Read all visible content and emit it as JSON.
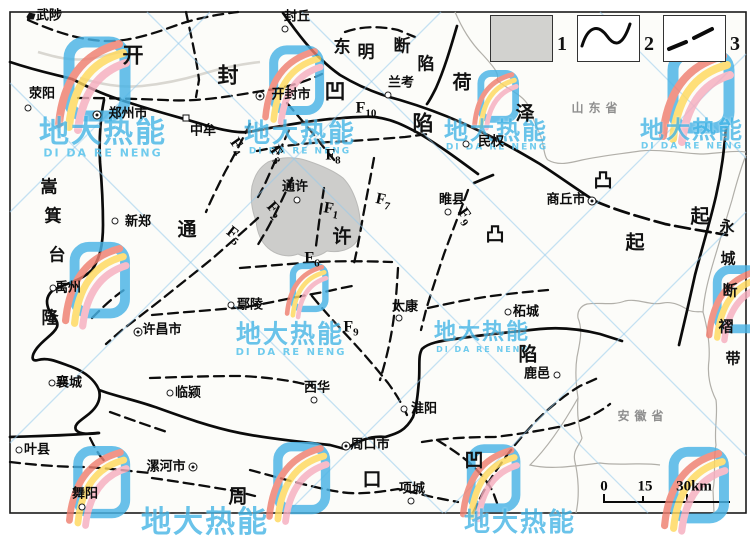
{
  "map_meta": {
    "description": "Regional geological structure sketch map (Henan area) with faults F1-F10",
    "colors": {
      "fault": "#0d0d0d",
      "province_boundary": "#b0aeaa",
      "uplift_shading": "#cbcbc9",
      "watermark_blue": "#45b5e6",
      "paper": "#ffffff"
    }
  },
  "legend": {
    "items": [
      {
        "num": "1",
        "meaning": "shaded-area"
      },
      {
        "num": "2",
        "meaning": "solid-curved-line"
      },
      {
        "num": "3",
        "meaning": "dashed-line"
      }
    ]
  },
  "scale_bar": {
    "labels": [
      "0",
      "15",
      "30km"
    ]
  },
  "provinces": [
    {
      "name": "山东省",
      "x": 597,
      "y": 108
    },
    {
      "name": "安徽省",
      "x": 643,
      "y": 416
    }
  ],
  "region_names": [
    "开封凹陷",
    "东明断陷",
    "荷泽凸起",
    "通许凸起",
    "嵩箕台隆",
    "永城断褶带",
    "周口凹陷"
  ],
  "region_chars": [
    {
      "region": "开封凹陷",
      "c": "开",
      "x": 133,
      "y": 55,
      "size": 21
    },
    {
      "region": "开封凹陷",
      "c": "封",
      "x": 228,
      "y": 75,
      "size": 21
    },
    {
      "region": "开封凹陷",
      "c": "凹",
      "x": 335,
      "y": 91,
      "size": 21
    },
    {
      "region": "开封凹陷",
      "c": "陷",
      "x": 423,
      "y": 123,
      "size": 21
    },
    {
      "region": "东明断陷",
      "c": "东",
      "x": 342,
      "y": 48,
      "size": 17
    },
    {
      "region": "东明断陷",
      "c": "明",
      "x": 366,
      "y": 53,
      "size": 17
    },
    {
      "region": "东明断陷",
      "c": "断",
      "x": 402,
      "y": 47,
      "size": 17
    },
    {
      "region": "东明断陷",
      "c": "陷",
      "x": 426,
      "y": 65,
      "size": 17
    },
    {
      "region": "荷泽凸起",
      "c": "荷",
      "x": 462,
      "y": 83,
      "size": 19
    },
    {
      "region": "荷泽凸起",
      "c": "泽",
      "x": 525,
      "y": 114,
      "size": 19
    },
    {
      "region": "荷泽凸起",
      "c": "凸",
      "x": 603,
      "y": 181,
      "size": 19
    },
    {
      "region": "荷泽凸起",
      "c": "起",
      "x": 700,
      "y": 217,
      "size": 19
    },
    {
      "region": "通许凸起",
      "c": "通",
      "x": 187,
      "y": 230,
      "size": 19
    },
    {
      "region": "通许凸起",
      "c": "许",
      "x": 342,
      "y": 237,
      "size": 19
    },
    {
      "region": "通许凸起",
      "c": "凸",
      "x": 495,
      "y": 235,
      "size": 19
    },
    {
      "region": "通许凸起",
      "c": "起",
      "x": 635,
      "y": 243,
      "size": 19
    },
    {
      "region": "嵩箕台隆",
      "c": "嵩",
      "x": 49,
      "y": 188,
      "size": 17
    },
    {
      "region": "嵩箕台隆",
      "c": "箕",
      "x": 53,
      "y": 217,
      "size": 17
    },
    {
      "region": "嵩箕台隆",
      "c": "台",
      "x": 57,
      "y": 256,
      "size": 17
    },
    {
      "region": "嵩箕台隆",
      "c": "隆",
      "x": 50,
      "y": 319,
      "size": 17
    },
    {
      "region": "永城断褶带",
      "c": "永",
      "x": 727,
      "y": 227,
      "size": 15
    },
    {
      "region": "永城断褶带",
      "c": "城",
      "x": 728,
      "y": 259,
      "size": 15
    },
    {
      "region": "永城断褶带",
      "c": "断",
      "x": 730,
      "y": 291,
      "size": 15
    },
    {
      "region": "永城断褶带",
      "c": "褶",
      "x": 726,
      "y": 327,
      "size": 15
    },
    {
      "region": "永城断褶带",
      "c": "带",
      "x": 733,
      "y": 359,
      "size": 15
    },
    {
      "region": "周口凹陷",
      "c": "周",
      "x": 238,
      "y": 497,
      "size": 19
    },
    {
      "region": "周口凹陷",
      "c": "口",
      "x": 372,
      "y": 480,
      "size": 19
    },
    {
      "region": "周口凹陷",
      "c": "凹",
      "x": 474,
      "y": 461,
      "size": 19
    },
    {
      "region": "周口凹陷",
      "c": "陷",
      "x": 528,
      "y": 355,
      "size": 19
    }
  ],
  "city_labels": [
    {
      "name": "武陟",
      "x": 49,
      "y": 16
    },
    {
      "name": "封丘",
      "x": 297,
      "y": 17
    },
    {
      "name": "荥阳",
      "x": 42,
      "y": 94
    },
    {
      "name": "郑州市",
      "x": 128,
      "y": 114
    },
    {
      "name": "中牟",
      "x": 203,
      "y": 131
    },
    {
      "name": "开封市",
      "x": 291,
      "y": 95
    },
    {
      "name": "兰考",
      "x": 401,
      "y": 83
    },
    {
      "name": "民权",
      "x": 491,
      "y": 142
    },
    {
      "name": "商丘市",
      "x": 566,
      "y": 200
    },
    {
      "name": "睢县",
      "x": 452,
      "y": 200
    },
    {
      "name": "新郑",
      "x": 138,
      "y": 222
    },
    {
      "name": "通许",
      "x": 295,
      "y": 187
    },
    {
      "name": "禹州",
      "x": 68,
      "y": 288
    },
    {
      "name": "许昌市",
      "x": 162,
      "y": 330
    },
    {
      "name": "鄢陵",
      "x": 250,
      "y": 305
    },
    {
      "name": "太康",
      "x": 405,
      "y": 307
    },
    {
      "name": "柘城",
      "x": 526,
      "y": 312
    },
    {
      "name": "鹿邑",
      "x": 537,
      "y": 374
    },
    {
      "name": "襄城",
      "x": 69,
      "y": 383
    },
    {
      "name": "临颍",
      "x": 188,
      "y": 393
    },
    {
      "name": "叶县",
      "x": 37,
      "y": 450
    },
    {
      "name": "漯河市",
      "x": 166,
      "y": 467
    },
    {
      "name": "舞阳",
      "x": 85,
      "y": 494
    },
    {
      "name": "西华",
      "x": 317,
      "y": 388
    },
    {
      "name": "淮阳",
      "x": 424,
      "y": 409
    },
    {
      "name": "周口市",
      "x": 370,
      "y": 445
    },
    {
      "name": "项城",
      "x": 412,
      "y": 489
    }
  ],
  "city_markers": [
    {
      "for": "武陟",
      "cls": "town",
      "x": 31,
      "y": 16
    },
    {
      "for": "封丘",
      "cls": "circle",
      "x": 285,
      "y": 29
    },
    {
      "for": "荥阳",
      "cls": "circle",
      "x": 28,
      "y": 108
    },
    {
      "for": "郑州市",
      "cls": "dcircle",
      "x": 97,
      "y": 115
    },
    {
      "for": "中牟",
      "cls": "square",
      "x": 186,
      "y": 118
    },
    {
      "for": "开封市",
      "cls": "dcircle",
      "x": 260,
      "y": 96
    },
    {
      "for": "兰考",
      "cls": "circle",
      "x": 388,
      "y": 95
    },
    {
      "for": "民权",
      "cls": "circle",
      "x": 466,
      "y": 144
    },
    {
      "for": "商丘市",
      "cls": "dcircle",
      "x": 592,
      "y": 201
    },
    {
      "for": "睢县",
      "cls": "circle",
      "x": 448,
      "y": 212
    },
    {
      "for": "新郑",
      "cls": "circle",
      "x": 115,
      "y": 221
    },
    {
      "for": "通许",
      "cls": "circle",
      "x": 297,
      "y": 200
    },
    {
      "for": "禹州",
      "cls": "circle",
      "x": 53,
      "y": 288
    },
    {
      "for": "许昌市",
      "cls": "dcircle",
      "x": 138,
      "y": 332
    },
    {
      "for": "鄢陵",
      "cls": "circle",
      "x": 231,
      "y": 305
    },
    {
      "for": "太康",
      "cls": "circle",
      "x": 399,
      "y": 318
    },
    {
      "for": "柘城",
      "cls": "circle",
      "x": 508,
      "y": 312
    },
    {
      "for": "鹿邑",
      "cls": "circle",
      "x": 557,
      "y": 375
    },
    {
      "for": "襄城",
      "cls": "circle",
      "x": 52,
      "y": 383
    },
    {
      "for": "临颍",
      "cls": "circle",
      "x": 170,
      "y": 393
    },
    {
      "for": "叶县",
      "cls": "circle",
      "x": 19,
      "y": 450
    },
    {
      "for": "漯河市",
      "cls": "dcircle",
      "x": 193,
      "y": 467
    },
    {
      "for": "舞阳",
      "cls": "circle",
      "x": 82,
      "y": 507
    },
    {
      "for": "西华",
      "cls": "circle",
      "x": 314,
      "y": 400
    },
    {
      "for": "淮阳",
      "cls": "circle",
      "x": 404,
      "y": 409
    },
    {
      "for": "周口市",
      "cls": "dcircle",
      "x": 346,
      "y": 446
    },
    {
      "for": "项城",
      "cls": "circle",
      "x": 411,
      "y": 501
    }
  ],
  "fault_labels": [
    {
      "f": "F",
      "sub": "10",
      "x": 366,
      "y": 110,
      "rot": 0
    },
    {
      "f": "F",
      "sub": "8",
      "x": 333,
      "y": 157,
      "rot": 0
    },
    {
      "f": "F",
      "sub": "4",
      "x": 236,
      "y": 147,
      "rot": 55
    },
    {
      "f": "F",
      "sub": "3",
      "x": 276,
      "y": 155,
      "rot": 55
    },
    {
      "f": "F",
      "sub": "2",
      "x": 273,
      "y": 211,
      "rot": 48
    },
    {
      "f": "F",
      "sub": "1",
      "x": 331,
      "y": 211,
      "rot": 10
    },
    {
      "f": "F",
      "sub": "7",
      "x": 383,
      "y": 202,
      "rot": 12
    },
    {
      "f": "F",
      "sub": "5",
      "x": 233,
      "y": 236,
      "rot": 38
    },
    {
      "f": "F",
      "sub": "6",
      "x": 312,
      "y": 260,
      "rot": 0
    },
    {
      "f": "F",
      "sub": "9",
      "x": 464,
      "y": 217,
      "rot": 55
    },
    {
      "f": "F",
      "sub": "9",
      "x": 351,
      "y": 329,
      "rot": 0
    }
  ],
  "watermark": {
    "cn": "地大热能",
    "en": "DI DA RE NENG",
    "instances_text": [
      {
        "text": "地大热能",
        "x": 103,
        "y": 133,
        "size": 30
      },
      {
        "text": "地大热能",
        "x": 300,
        "y": 134,
        "size": 26
      },
      {
        "text": "地大热能",
        "x": 496,
        "y": 131,
        "size": 24
      },
      {
        "text": "地大热能",
        "x": 692,
        "y": 130,
        "size": 24
      },
      {
        "text": "地大热能",
        "x": 290,
        "y": 334,
        "size": 25
      },
      {
        "text": "地大热能",
        "x": 482,
        "y": 333,
        "size": 22
      },
      {
        "text": "地大热能",
        "x": 205,
        "y": 523,
        "size": 30
      },
      {
        "text": "地大热能",
        "x": 520,
        "y": 523,
        "size": 26
      }
    ],
    "instances_en": [
      {
        "text": "DI DA RE NENG",
        "x": 103,
        "y": 153,
        "size": 11
      },
      {
        "text": "DI DA RE NENG",
        "x": 300,
        "y": 152,
        "size": 9
      },
      {
        "text": "DI DA RE NENG",
        "x": 497,
        "y": 148,
        "size": 9
      },
      {
        "text": "DI DA RE NENG",
        "x": 692,
        "y": 147,
        "size": 9
      },
      {
        "text": "DI DA RE NENG",
        "x": 291,
        "y": 353,
        "size": 10
      },
      {
        "text": "DI DA RE NENG",
        "x": 483,
        "y": 350,
        "size": 8
      }
    ],
    "instances_logo": [
      {
        "x": 95,
        "y": 80,
        "s": 1.0
      },
      {
        "x": 295,
        "y": 81,
        "s": 0.82
      },
      {
        "x": 497,
        "y": 97,
        "s": 0.62
      },
      {
        "x": 699,
        "y": 92,
        "s": 1.0
      },
      {
        "x": 98,
        "y": 281,
        "s": 0.9
      },
      {
        "x": 308,
        "y": 288,
        "s": 0.58
      },
      {
        "x": 738,
        "y": 300,
        "s": 0.8
      },
      {
        "x": 100,
        "y": 483,
        "s": 0.85
      },
      {
        "x": 300,
        "y": 479,
        "s": 0.85
      },
      {
        "x": 492,
        "y": 479,
        "s": 0.8
      },
      {
        "x": 697,
        "y": 486,
        "s": 0.9
      }
    ]
  }
}
